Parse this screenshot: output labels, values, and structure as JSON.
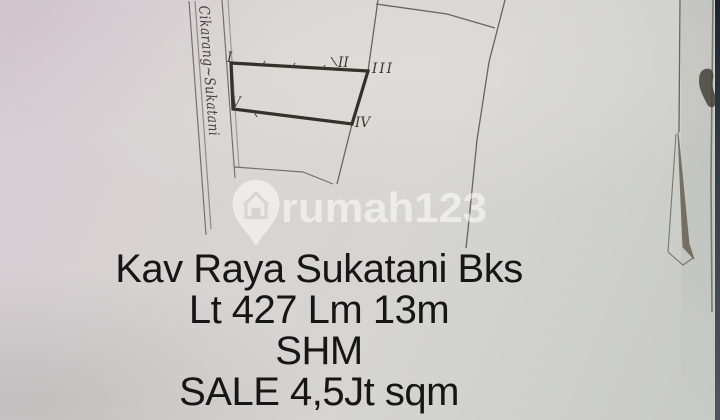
{
  "sketch": {
    "road_label": "Cikarang~Sukatani",
    "corners": {
      "c1": "I",
      "c2": "II",
      "c3": "III",
      "c4": "IV",
      "c5": "V"
    }
  },
  "watermark": {
    "brand": "rumah123",
    "logo": "location-pin-house",
    "tint": "#ffffff"
  },
  "caption": {
    "line1": "Kav Raya Sukatani Bks",
    "line2": "Lt 427 Lm 13m",
    "line3": "SHM",
    "line4": "SALE 4,5Jt sqm"
  },
  "colors": {
    "paper": "#d5d2cf",
    "ink": "#161616",
    "sketch_line": "#55524a",
    "plot_border": "#33312a",
    "screen_edge": "#20252d"
  }
}
